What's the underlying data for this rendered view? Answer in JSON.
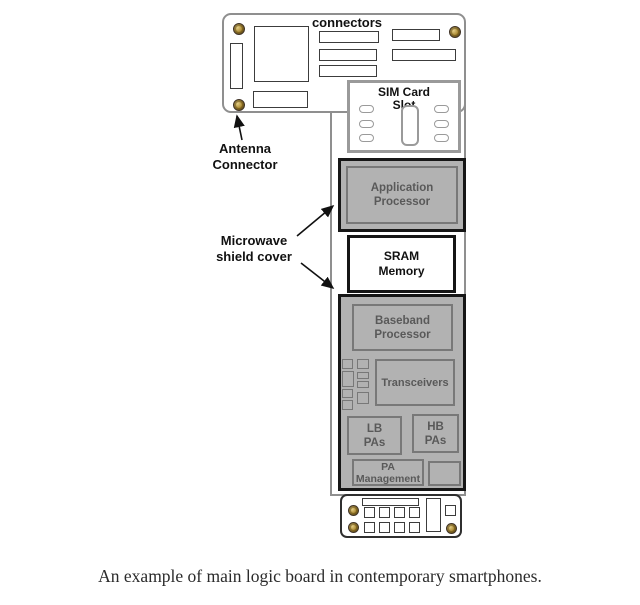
{
  "labels": {
    "connectors": "connectors",
    "antenna_connector": [
      "Antenna",
      "Connector"
    ],
    "microwave_shield_cover": [
      "Microwave",
      "shield cover"
    ]
  },
  "components": {
    "sim_card_slot": [
      "SIM Card",
      "Slot"
    ],
    "application_processor": [
      "Application",
      "Processor"
    ],
    "sram_memory": [
      "SRAM",
      "Memory"
    ],
    "baseband_processor": [
      "Baseband",
      "Processor"
    ],
    "transceivers": "Transceivers",
    "lb_pas": [
      "LB",
      "PAs"
    ],
    "hb_pas": [
      "HB",
      "PAs"
    ],
    "pa_management": [
      "PA",
      "Management"
    ]
  },
  "caption": "An example of main logic board in contemporary smartphones.",
  "colors": {
    "board_border": "#8f8f8f",
    "shield_border": "#161616",
    "shield_fill": "#b2b2b2",
    "component_border": "#787878",
    "component_text": "#595959",
    "screw_gold": "#a8862e",
    "label_text": "#111111"
  }
}
